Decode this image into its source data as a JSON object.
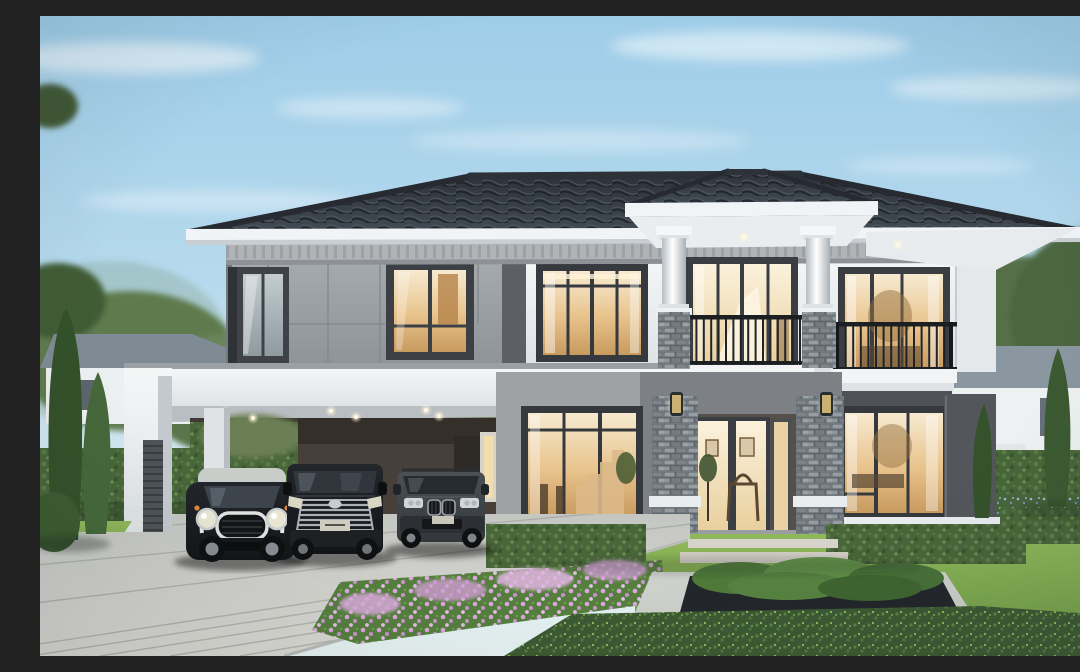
{
  "scene": {
    "title": "Modern two-storey luxury house exterior at dusk",
    "description": "3D architectural rendering of a modern two-storey detached house with a dark grey hipped tile roof and white fascia, white render and grey panel cladding, grey ledgestone piers, a double-height entry portico with two round white columns, two first-floor balconies with black metal railings, tall warm-lit glass entry doors, an attached flat-roof white carport with recessed downlights sheltering three cars, a paved driveway, landscaped front garden with clipped hedges, conifer trees, a pink flower bed and a concrete planter, neighbouring white houses on both sides under a pale blue evening sky.",
    "sky": {
      "condition": "clear with thin wispy clouds",
      "top_color": "#9ecde8",
      "horizon_color": "#e9f4f3"
    },
    "house": {
      "storeys": 2,
      "roof": {
        "style": "hipped",
        "material": "concrete tile",
        "color": "#343a41",
        "fascia_color": "#f1f4f6",
        "soffit_downlights": 2
      },
      "facade": {
        "white_render": "#eef1f3",
        "grey_panel_cladding": "#9aa0a4",
        "dark_grey_accent": "#55595d",
        "ledgestone_piers": "#8a9197"
      },
      "portico": {
        "round_columns": 2,
        "column_color": "#ffffff",
        "stone_piers": 2,
        "wall_sconces": 2
      },
      "balconies": {
        "count": 2,
        "railing_color": "#1f2225",
        "railing_style": "vertical black metal balusters"
      },
      "upper_windows": 5,
      "lower_windows": 2,
      "entry_door": {
        "type": "tall double glass door",
        "frame_color": "#3a3e42",
        "interior_glow": "#f3dfae",
        "interior_details": [
          "console table",
          "framed wall art",
          "potted plant"
        ]
      }
    },
    "carport": {
      "structure": "white flat-roof frame attached to house",
      "downlight_count": 6,
      "louvre_panel": "dark grey vertical slat panel on outer column",
      "rear": [
        "green hedge",
        "dark brown rear wall",
        "side door with warm light"
      ],
      "vehicles": [
        {
          "name": "mini-hatchback",
          "description": "black compact hatchback with silver roof, chrome-ringed round headlights and white grille trim"
        },
        {
          "name": "luxury-van",
          "description": "black luxury MPV van with large chrome multi-bar grille"
        },
        {
          "name": "suv",
          "description": "dark grey SUV with twin kidney grilles"
        }
      ]
    },
    "garden": {
      "lawn_color": "#7ba951",
      "hedge_color": "#4e6b3d",
      "conifers_left": 2,
      "conifers_right": 2,
      "flower_bed": {
        "flower_color": "#d9aad8",
        "position": "along driveway edge"
      },
      "planter": {
        "border": "light concrete",
        "inner": "dark pebble bed with clipped green shrubs"
      },
      "stepping_stones": 2,
      "ground_cover": "dark green creeping shrubs with yellow-green speckles"
    },
    "driveway": {
      "surface": "large light grey pavers with diagonal joints",
      "color": "#cfd0cb"
    },
    "neighbours": {
      "left": "white house with grey hipped roof behind conifers",
      "right": "white house with grey-blue hipped roof behind hedge wall"
    },
    "palette": {
      "sky_blue": "#9ecde8",
      "roof_tile": "#343a41",
      "fascia_white": "#f1f4f6",
      "wall_white": "#eef1f3",
      "wall_grey_panel": "#9aa0a4",
      "wall_dark_grey": "#55595d",
      "stone_grey": "#8a9197",
      "window_frame": "#33373b",
      "interior_glow": "#f3dfae",
      "railing_black": "#1f2225",
      "hedge_green": "#4e6b3d",
      "lawn_green": "#7ba951",
      "conifer_green": "#3a5730",
      "flower_pink": "#d9aad8",
      "driveway_grey": "#cfd0cb",
      "car_black": "#1b1e22",
      "car_grey": "#3e4347"
    }
  }
}
